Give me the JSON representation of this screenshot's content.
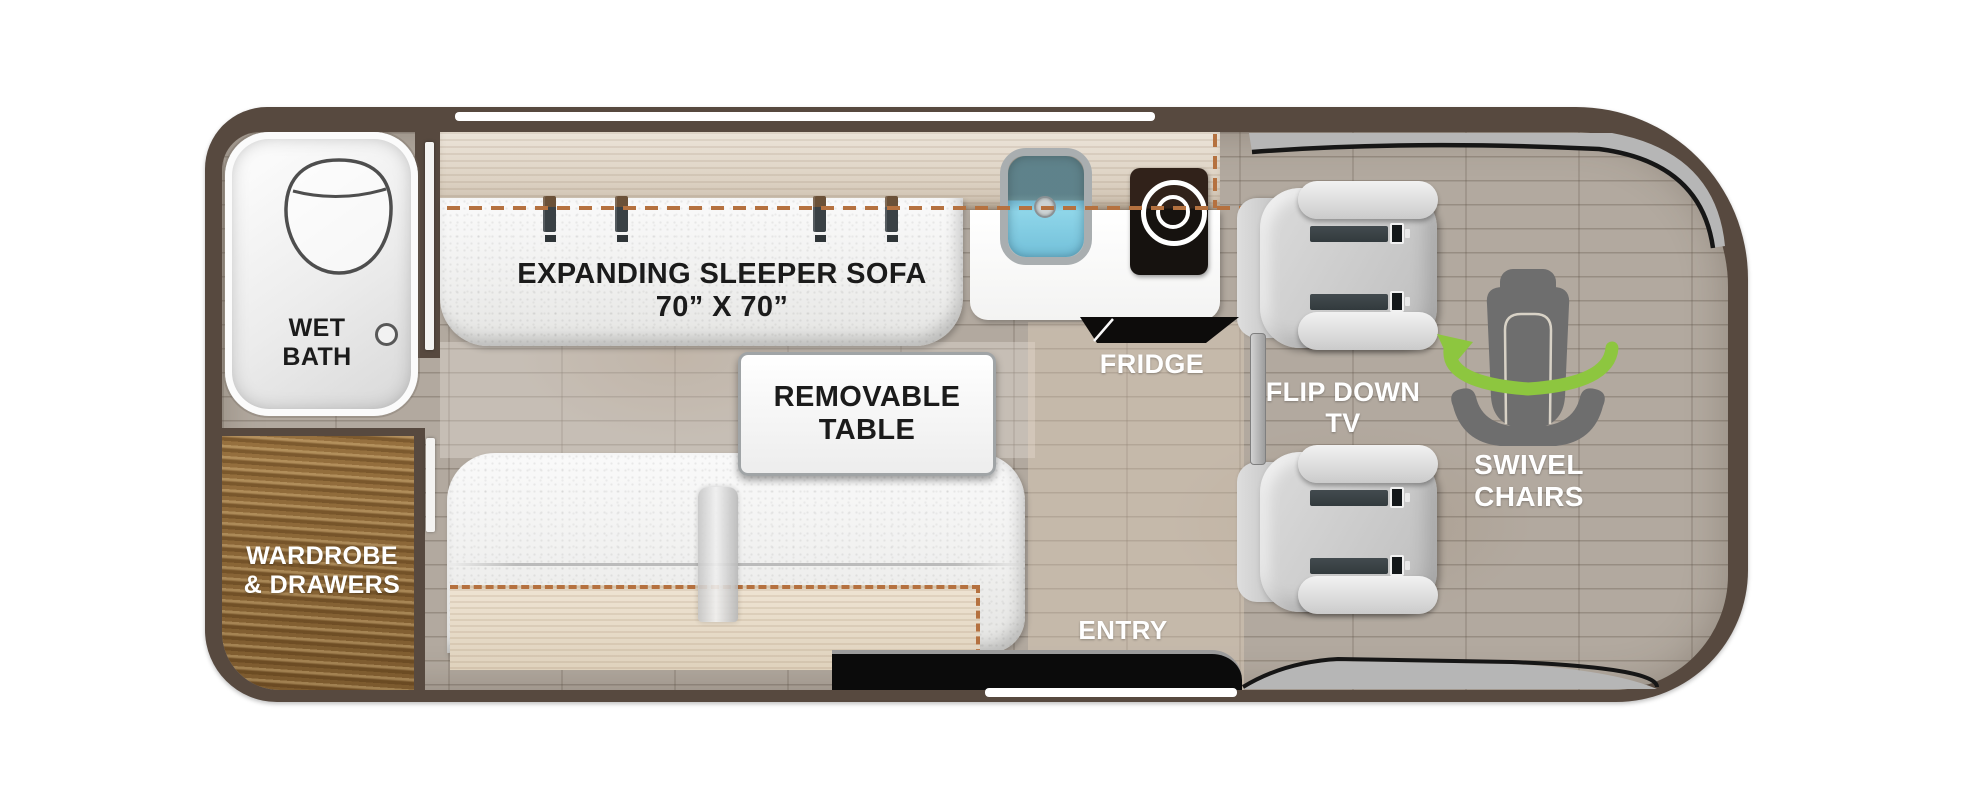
{
  "areas": {
    "wet_bath": {
      "line1": "WET",
      "line2": "BATH"
    },
    "wardrobe": {
      "line1": "WARDROBE",
      "line2": "& DRAWERS"
    },
    "sleeper_sofa": {
      "line1": "EXPANDING SLEEPER SOFA",
      "line2": "70” X 70”"
    },
    "removable_table": {
      "line1": "REMOVABLE",
      "line2": "TABLE"
    },
    "fridge": {
      "label": "FRIDGE"
    },
    "entry": {
      "label": "ENTRY"
    },
    "flip_down_tv": {
      "line1": "FLIP DOWN",
      "line2": "TV"
    },
    "swivel_chairs": {
      "line1": "SWIVEL",
      "line2": "CHAIRS"
    }
  },
  "colors": {
    "body_outline": "#57493F",
    "floor": "#B2A99F",
    "bed_outline_dash": "#B5713F",
    "swivel_arrow_green": "#8DC63F",
    "cabinet_wood": "#8A6A3E",
    "counter_wood": "#DFD6C9",
    "appliance_black": "#121010",
    "sink_blue": "#7FD0E6",
    "label_dark": "#1B1B1B",
    "label_light": "#FFFFFF"
  }
}
